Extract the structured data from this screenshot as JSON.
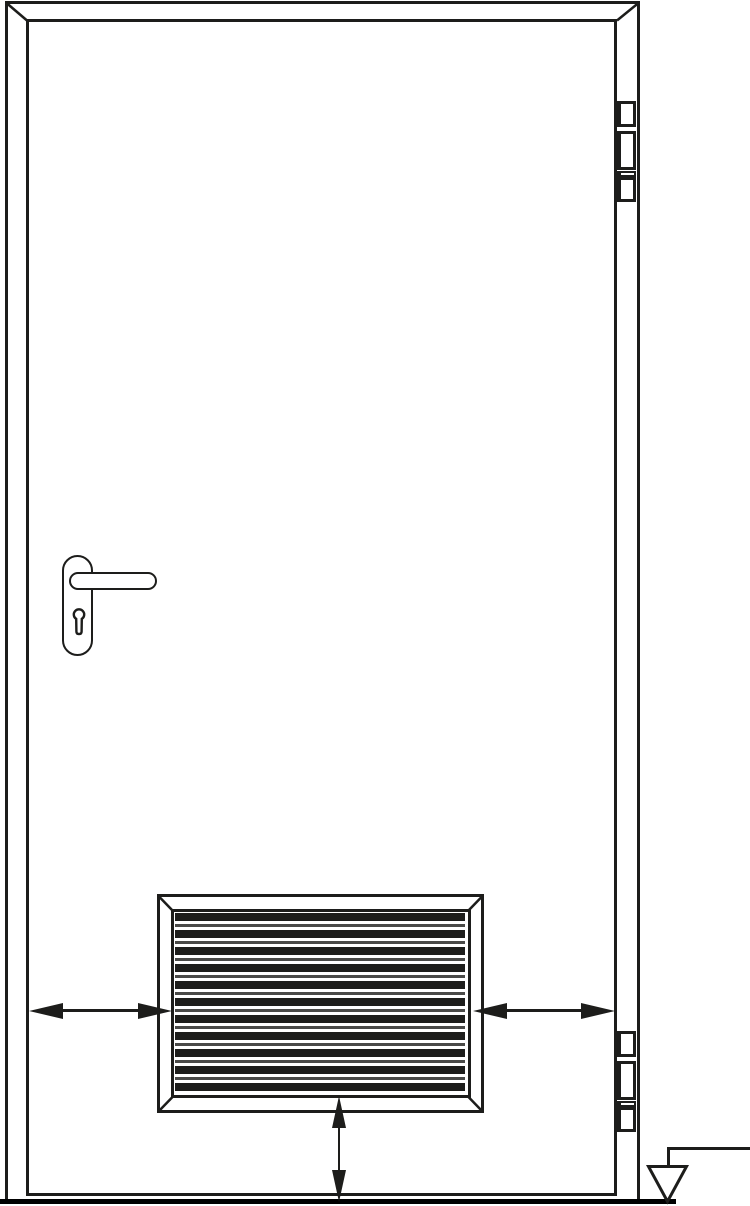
{
  "diagram": {
    "kind": "technical line drawing",
    "subject": "single-leaf door, elevation view, with louvered ventilation grille",
    "colors": {
      "background": "#ffffff",
      "line": "#1d1d1b",
      "louver_thin_line": "#4a4a48",
      "ground": "#000000"
    },
    "components": {
      "door_frame": "door frame with mitered top corners",
      "door_leaf": "door leaf",
      "handle": "lever handle on rounded backplate",
      "keyhole": "euro-profile cylinder keyhole",
      "hinge_top": "top barrel hinge, three knuckles",
      "hinge_bottom": "bottom barrel hinge, three knuckles",
      "grille": "louvered ventilation grille with mitered frame",
      "arrow_left": "double-headed horizontal arrow, door leaf edge to grille left side",
      "arrow_right": "double-headed horizontal arrow, grille right side to door leaf edge",
      "arrow_bottom": "double-headed vertical arrow, grille bottom to floor line",
      "floor_line": "floor line",
      "floor_level_symbol": "inverted open triangle datum symbol with leader line to right edge"
    },
    "grille": {
      "thick_slat_count": 11,
      "thin_line_count": 10,
      "slat_pitch_px": 17
    },
    "hinges": {
      "count": 2,
      "knuckles_per_hinge": 3
    }
  }
}
